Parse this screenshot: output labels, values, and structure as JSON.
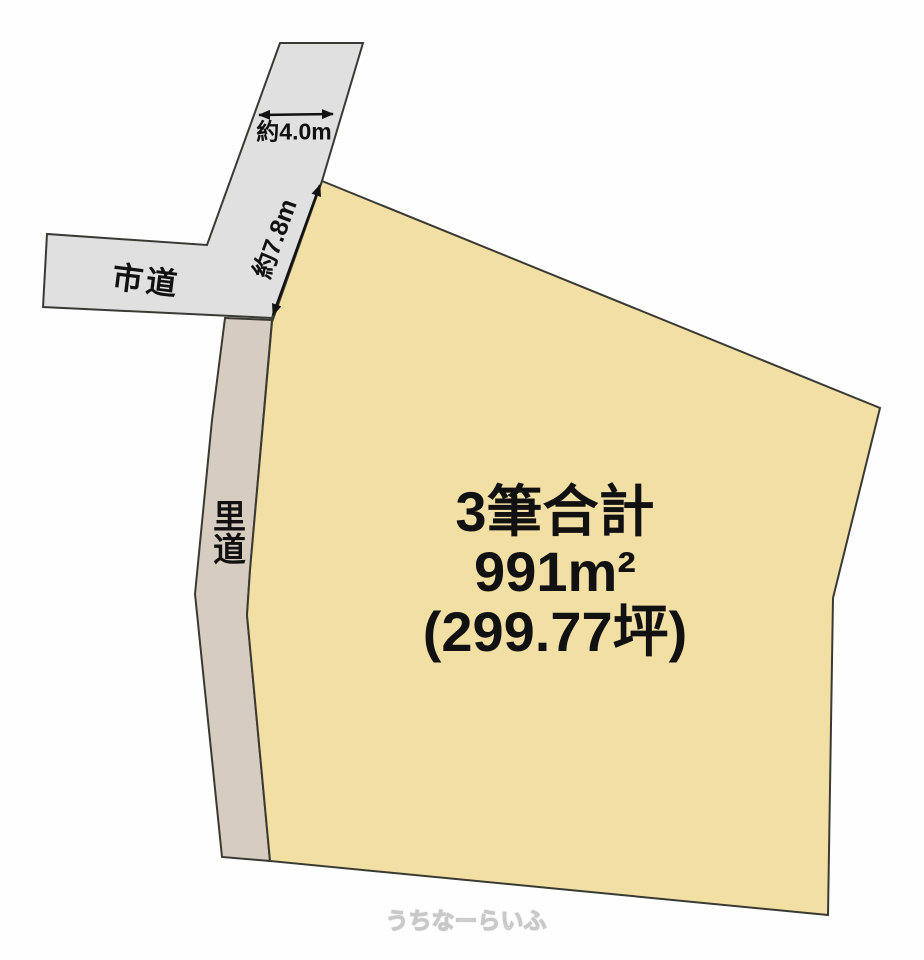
{
  "diagram": {
    "type": "land-plot-layout",
    "labels": {
      "city_road": "市道",
      "village_road": "里道",
      "width_dimension": "約4.0m",
      "frontage_dimension": "約7.8m"
    },
    "parcel": {
      "line1": "3筆合計",
      "line2": "991m²",
      "line3": "(299.77坪)"
    },
    "watermark": "うちなーらいふ",
    "colors": {
      "parcel_fill": "#f2dfa4",
      "city_road_fill": "#e0e0e0",
      "village_road_fill": "#d6ccbf",
      "outline": "#3a3a34",
      "dimension_line": "#121212",
      "text": "#111111"
    }
  }
}
